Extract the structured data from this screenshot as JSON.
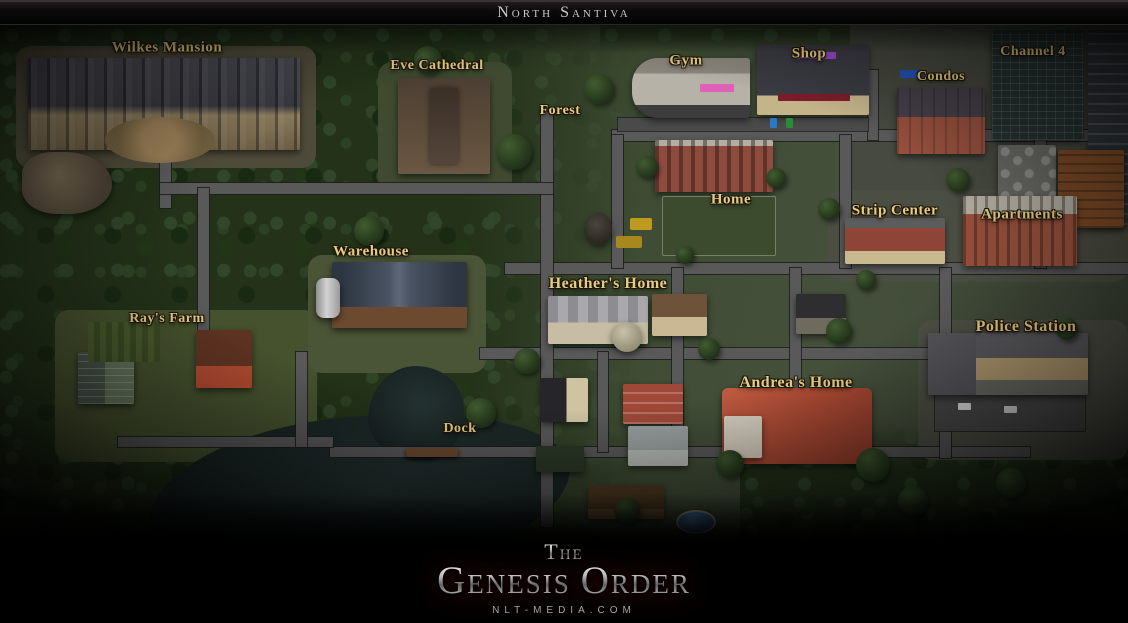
{
  "title_bar": {
    "title": "North Santiva"
  },
  "map": {
    "region_name": "North Santiva",
    "locations": [
      {
        "id": "wilkes-mansion",
        "label": "Wilkes Mansion"
      },
      {
        "id": "eve-cathedral",
        "label": "Eve Cathedral"
      },
      {
        "id": "forest",
        "label": "Forest"
      },
      {
        "id": "gym",
        "label": "Gym"
      },
      {
        "id": "shop",
        "label": "Shop"
      },
      {
        "id": "condos",
        "label": "Condos"
      },
      {
        "id": "channel-4",
        "label": "Channel 4"
      },
      {
        "id": "home",
        "label": "Home"
      },
      {
        "id": "strip-center",
        "label": "Strip Center"
      },
      {
        "id": "apartments",
        "label": "Apartments"
      },
      {
        "id": "warehouse",
        "label": "Warehouse"
      },
      {
        "id": "heathers-home",
        "label": "Heather's Home"
      },
      {
        "id": "police-station",
        "label": "Police Station"
      },
      {
        "id": "rays-farm",
        "label": "Ray's Farm"
      },
      {
        "id": "andreas-home",
        "label": "Andrea's Home"
      },
      {
        "id": "dock",
        "label": "Dock"
      }
    ]
  },
  "footer": {
    "logo_prefix": "The",
    "logo_word1": "Genesis",
    "logo_word2": "Order",
    "website": "NLT-MEDIA.COM"
  },
  "colors": {
    "label_gold": "#e5cd82",
    "logo_silver": "#c9c9c9",
    "logo_red_glow": "#8c0c0c",
    "road_gray": "#595959",
    "water_dark": "#1b2726",
    "forest_green": "#233219",
    "grass_green": "#45503b"
  }
}
